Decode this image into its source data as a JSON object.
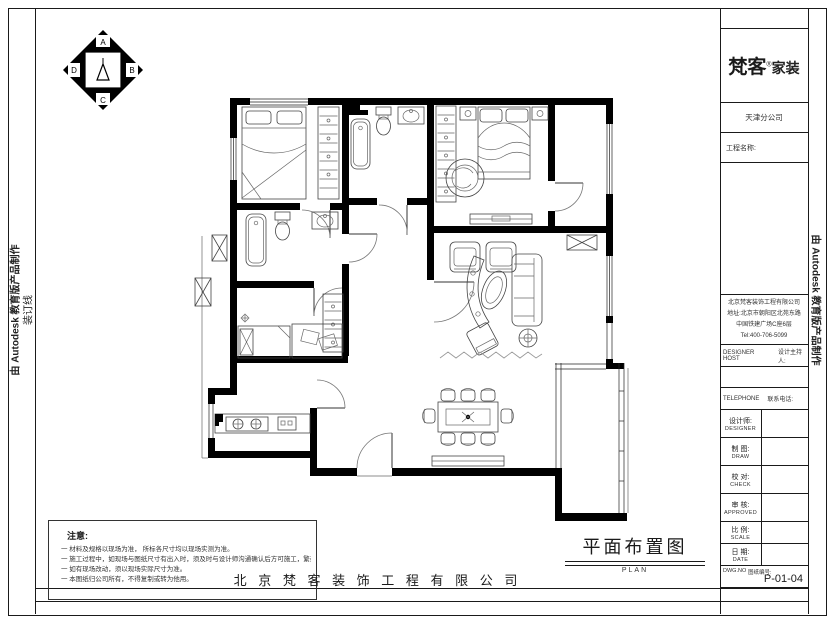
{
  "frame": {
    "binding_line_label": "装订线",
    "autodesk_credit_left": "由 Autodesk 教育版产品制作",
    "autodesk_credit_right": "由 Autodesk 教育版产品制作"
  },
  "logo": {
    "brand": "梵客",
    "reg": "®",
    "suffix": "家装"
  },
  "compass": {
    "letters": [
      "A",
      "B",
      "C",
      "D"
    ]
  },
  "title_block": {
    "branch": "天津分公司",
    "project_label": "工程名称:",
    "company_lines": [
      "北京梵客装饰工程有限公司",
      "地址:北京市朝阳区北苑东路",
      "中国铁建广场C座6层",
      "Tel:400-706-5099"
    ],
    "designer_host_en": "DESIGNER HOST",
    "designer_host_cn": "设计主持人:",
    "telephone_en": "TELEPHONE",
    "telephone_cn": "联系电话:",
    "rows": [
      {
        "cn": "设计师:",
        "en": "DESIGNER"
      },
      {
        "cn": "制 图:",
        "en": "DRAW"
      },
      {
        "cn": "校 对:",
        "en": "CHECK"
      },
      {
        "cn": "审 核:",
        "en": "APPROVED"
      },
      {
        "cn": "比 例:",
        "en": "SCALE"
      },
      {
        "cn": "日 期:",
        "en": "DATE"
      }
    ],
    "dwg_en": "DWG.NO",
    "dwg_cn": "图纸编号:",
    "dwg_value": "P-01-04"
  },
  "notes": {
    "title": "注意:",
    "items": [
      "一 材料及规格以现场为准， 所标各尺寸均以现场实测为准。",
      "一 施工过程中，如现场与图纸尺寸有出入时，须及时与设计师沟通确认后方可施工，繁杂处以现场交底为准。",
      "一 如有现场改动，须以现场实际尺寸为准。",
      "一 本图纸归公司所有，不得复制或转为他用。"
    ]
  },
  "footer": {
    "drawing_title": "平面布置图",
    "drawing_subtitle": "PLAN",
    "company_name": "北 京 梵 客 装 饰 工 程 有 限 公 司"
  }
}
